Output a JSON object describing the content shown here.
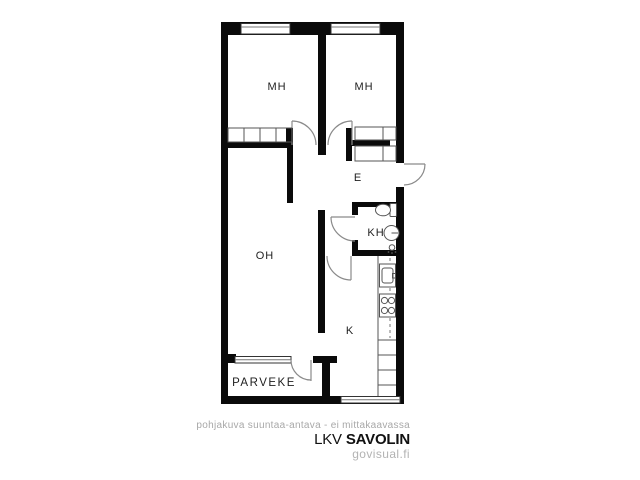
{
  "floor_plan": {
    "rooms": [
      {
        "id": "bedroom-1",
        "label": "MH"
      },
      {
        "id": "bedroom-2",
        "label": "MH"
      },
      {
        "id": "hallway",
        "label": "E"
      },
      {
        "id": "bathroom",
        "label": "KH"
      },
      {
        "id": "living-room",
        "label": "OH"
      },
      {
        "id": "kitchen",
        "label": "K"
      },
      {
        "id": "balcony",
        "label": "PARVEKE"
      }
    ]
  },
  "footer": {
    "disclaimer": "pohjakuva suuntaa-antava - ei mittakaavassa",
    "brand_prefix": "LKV",
    "brand_name": "SAVOLIN",
    "website": "govisual.fi"
  },
  "colors": {
    "wall": "#0a0a0a",
    "fixture": "#555555",
    "door_arc": "#8a8a8a",
    "text": "#1e1e1e",
    "muted": "#a8a8a8"
  }
}
